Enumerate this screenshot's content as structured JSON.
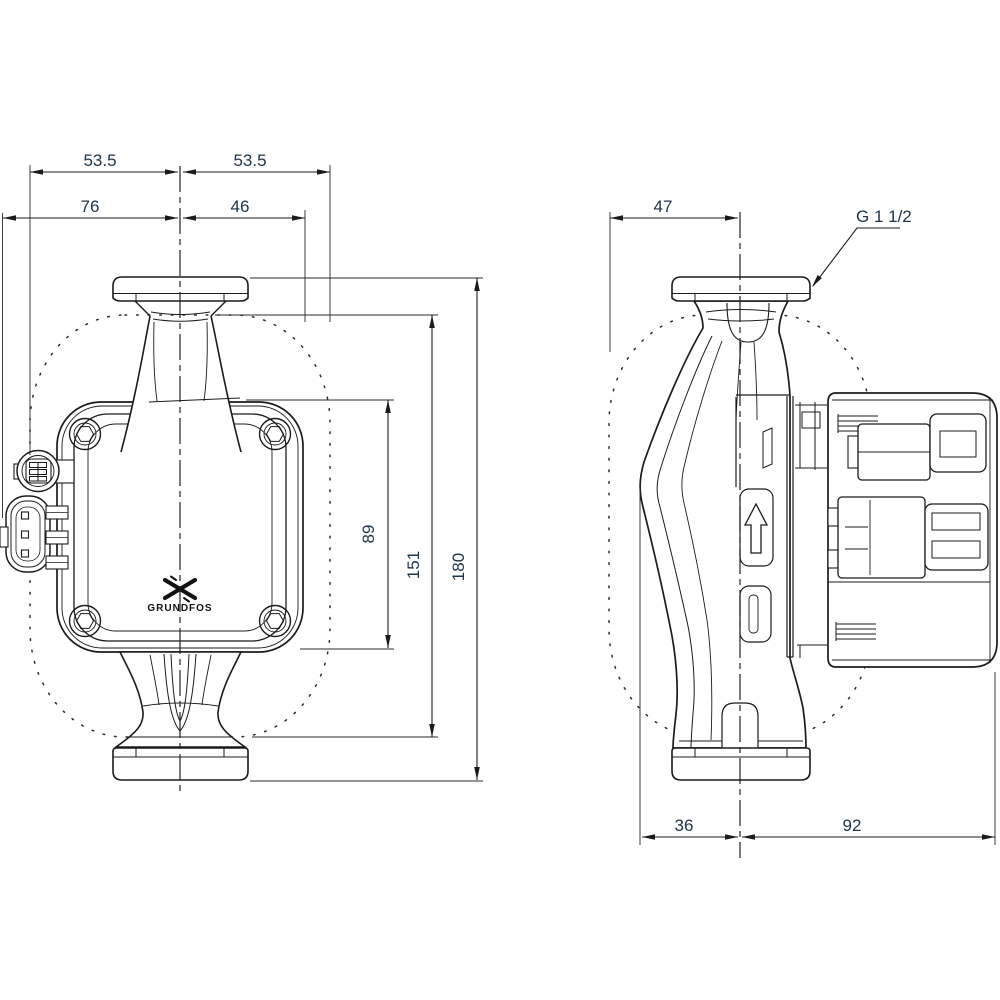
{
  "colors": {
    "background": "#ffffff",
    "line": "#1b1b1b",
    "dim_text": "#20344a"
  },
  "front_view": {
    "dims": {
      "half_width_left": "53.5",
      "half_width_right": "53.5",
      "overall_width_left": "76",
      "overall_width_right": "46",
      "control_box_height": "89",
      "housing_height": "151",
      "port_to_port": "180"
    },
    "logo_text": "GRUNDFOS"
  },
  "side_view": {
    "dims": {
      "front_depth": "47",
      "foot_depth": "36",
      "rear_depth": "92"
    },
    "connection_label": "G 1 1/2"
  }
}
